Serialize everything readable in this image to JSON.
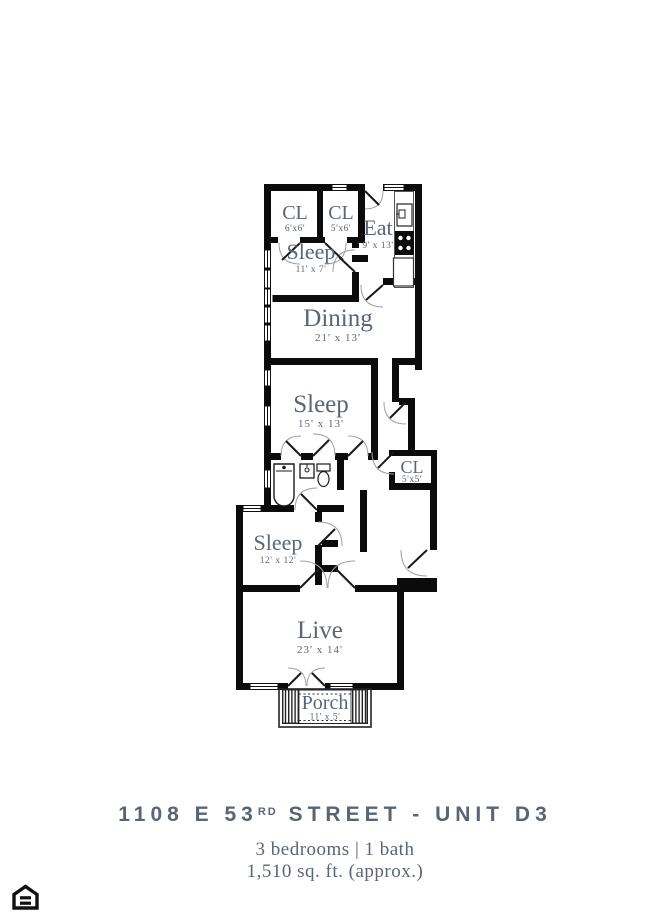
{
  "plan": {
    "rooms": [
      {
        "name": "CL",
        "dims": "6'x6'"
      },
      {
        "name": "CL",
        "dims": "5'x6'"
      },
      {
        "name": "Eat",
        "dims": "9' x 13'"
      },
      {
        "name": "Sleep",
        "dims": "11' x 7'"
      },
      {
        "name": "Dining",
        "dims": "21' x 13'"
      },
      {
        "name": "Sleep",
        "dims": "15' x 13'"
      },
      {
        "name": "CL",
        "dims": "5'x5'"
      },
      {
        "name": "Sleep",
        "dims": "12' x 12'"
      },
      {
        "name": "Live",
        "dims": "23' x 14'"
      },
      {
        "name": "Porch",
        "dims": "11' x 5'"
      }
    ],
    "colors": {
      "wall": "#0b0b0b",
      "label": "#5c6577"
    }
  },
  "footer": {
    "address_prefix": "1108 E 53",
    "address_ordinal": "RD",
    "address_suffix": " STREET - UNIT D3",
    "details_line1": "3 bedrooms | 1 bath",
    "details_line2": "1,510 sq. ft. (approx.)",
    "title_color": "#5b6475"
  }
}
